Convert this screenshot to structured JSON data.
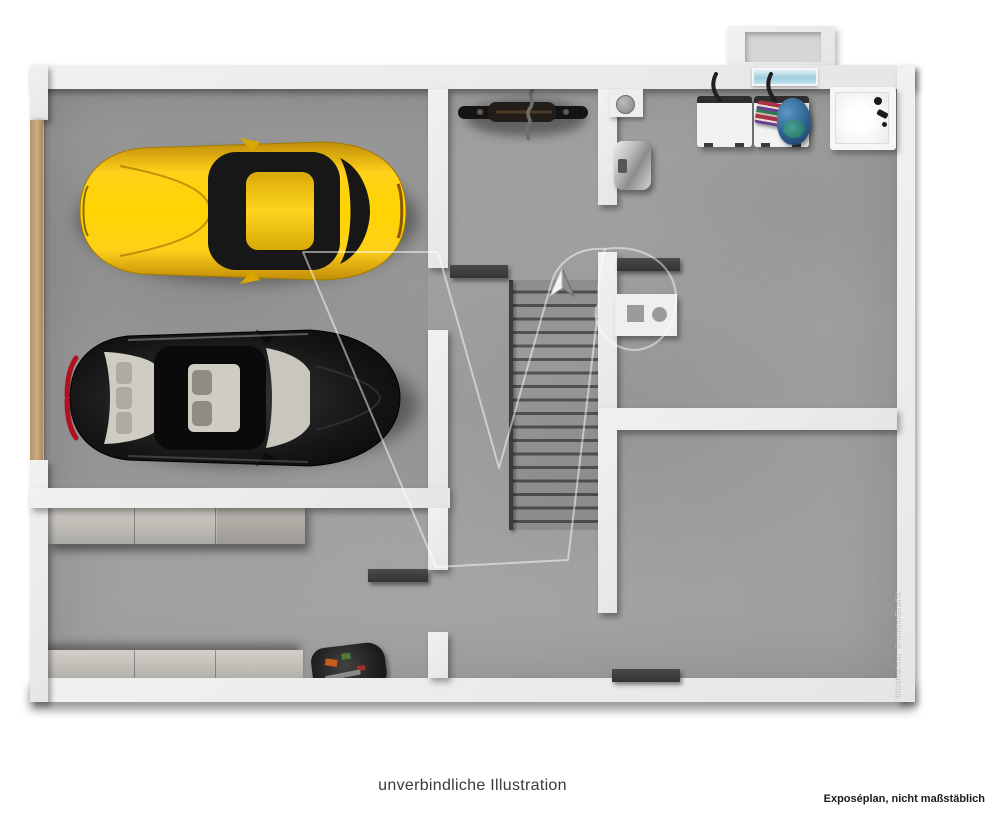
{
  "page": {
    "caption": "unverbindliche Illustration",
    "footnote": "Exposéplan, nicht maßstäblich",
    "credit_vertical": "Illustration ©immoGrafik"
  },
  "floorplan": {
    "view": "3D top-down basement / garage floor plan, no room labels or dimensions shown",
    "stairs": {
      "direction_arrow": "up",
      "treads": 19,
      "location": "center"
    },
    "colors": {
      "wall": "#ebebeb",
      "floor_concrete": "#9e9e9e",
      "garage_door_wood": "#c3a27a",
      "car_yellow": "#f9c800",
      "car_black": "#101010",
      "taillight_red": "#b01020",
      "light_shaft_window_blue": "#aed9e6",
      "open_door_marker": "#3f3f3f",
      "appliance_white": "#f2f2f2",
      "laundry_pile_blue": "#2d5f8e",
      "shelf_gray": "#c6c3bd",
      "caption_text": "#3a3a3a"
    },
    "objects": [
      {
        "name": "yellow-sports-car",
        "area": "garage",
        "facing": "left"
      },
      {
        "name": "black-sedan",
        "area": "garage",
        "facing": "right"
      },
      {
        "name": "bicycle",
        "area": "upper-hall"
      },
      {
        "name": "staircase-with-up-arrow",
        "area": "center"
      },
      {
        "name": "washing-machine",
        "area": "utility-room"
      },
      {
        "name": "washing-machine-with-laundry-pile-and-towels",
        "area": "utility-room"
      },
      {
        "name": "shower-tray-with-fittings",
        "area": "utility-room"
      },
      {
        "name": "metal-boiler",
        "area": "utility-room"
      },
      {
        "name": "floor-drain",
        "area": "utility-room"
      },
      {
        "name": "counter-with-square-and-round-basin",
        "area": "stair-hall"
      },
      {
        "name": "storage-shelf",
        "area": "storage-room",
        "count": 2
      },
      {
        "name": "toolbox",
        "area": "storage-room"
      },
      {
        "name": "garage-door-strip",
        "area": "left-exterior-wall"
      },
      {
        "name": "light-shaft-with-window",
        "area": "top-exterior-wall"
      },
      {
        "name": "open-door-marker",
        "count": 4
      }
    ]
  }
}
